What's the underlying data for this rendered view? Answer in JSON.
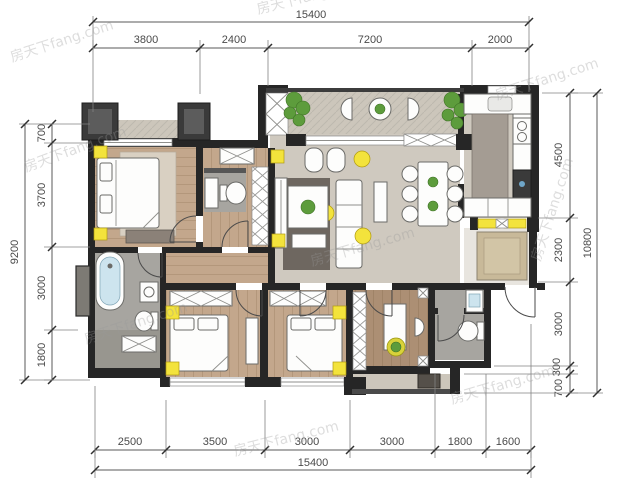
{
  "watermark": {
    "text": "房天下fang.com"
  },
  "dimensions": {
    "top": {
      "total": "15400",
      "segments": [
        "3800",
        "2400",
        "7200",
        "2000"
      ]
    },
    "bottom": {
      "total": "15400",
      "segments": [
        "2500",
        "3500",
        "3000",
        "3000",
        "1800",
        "1600"
      ]
    },
    "left": {
      "total": "9200",
      "segments": [
        "700",
        "3700",
        "3000",
        "1800"
      ]
    },
    "right": {
      "total": "10800",
      "segments": [
        "4500",
        "2300",
        "3000",
        "300",
        "700"
      ]
    }
  },
  "colors": {
    "wall": "#262626",
    "accent_yellow": "#f3e33c",
    "plant_green": "#5d9c3c",
    "wood_floor": "#c3a78c",
    "wood_floor_dark": "#ac8f74",
    "marble_floor": "#cfc9bf",
    "stone_floor": "#ccc6bb",
    "tile_gray": "#a7a5a0",
    "beige_mat": "#c8b999",
    "rug_dark": "#6e6760",
    "water_blue": "#cde4ee",
    "dim_line": "#5a5a5a",
    "watermark_gray": "#9a9a9a"
  }
}
